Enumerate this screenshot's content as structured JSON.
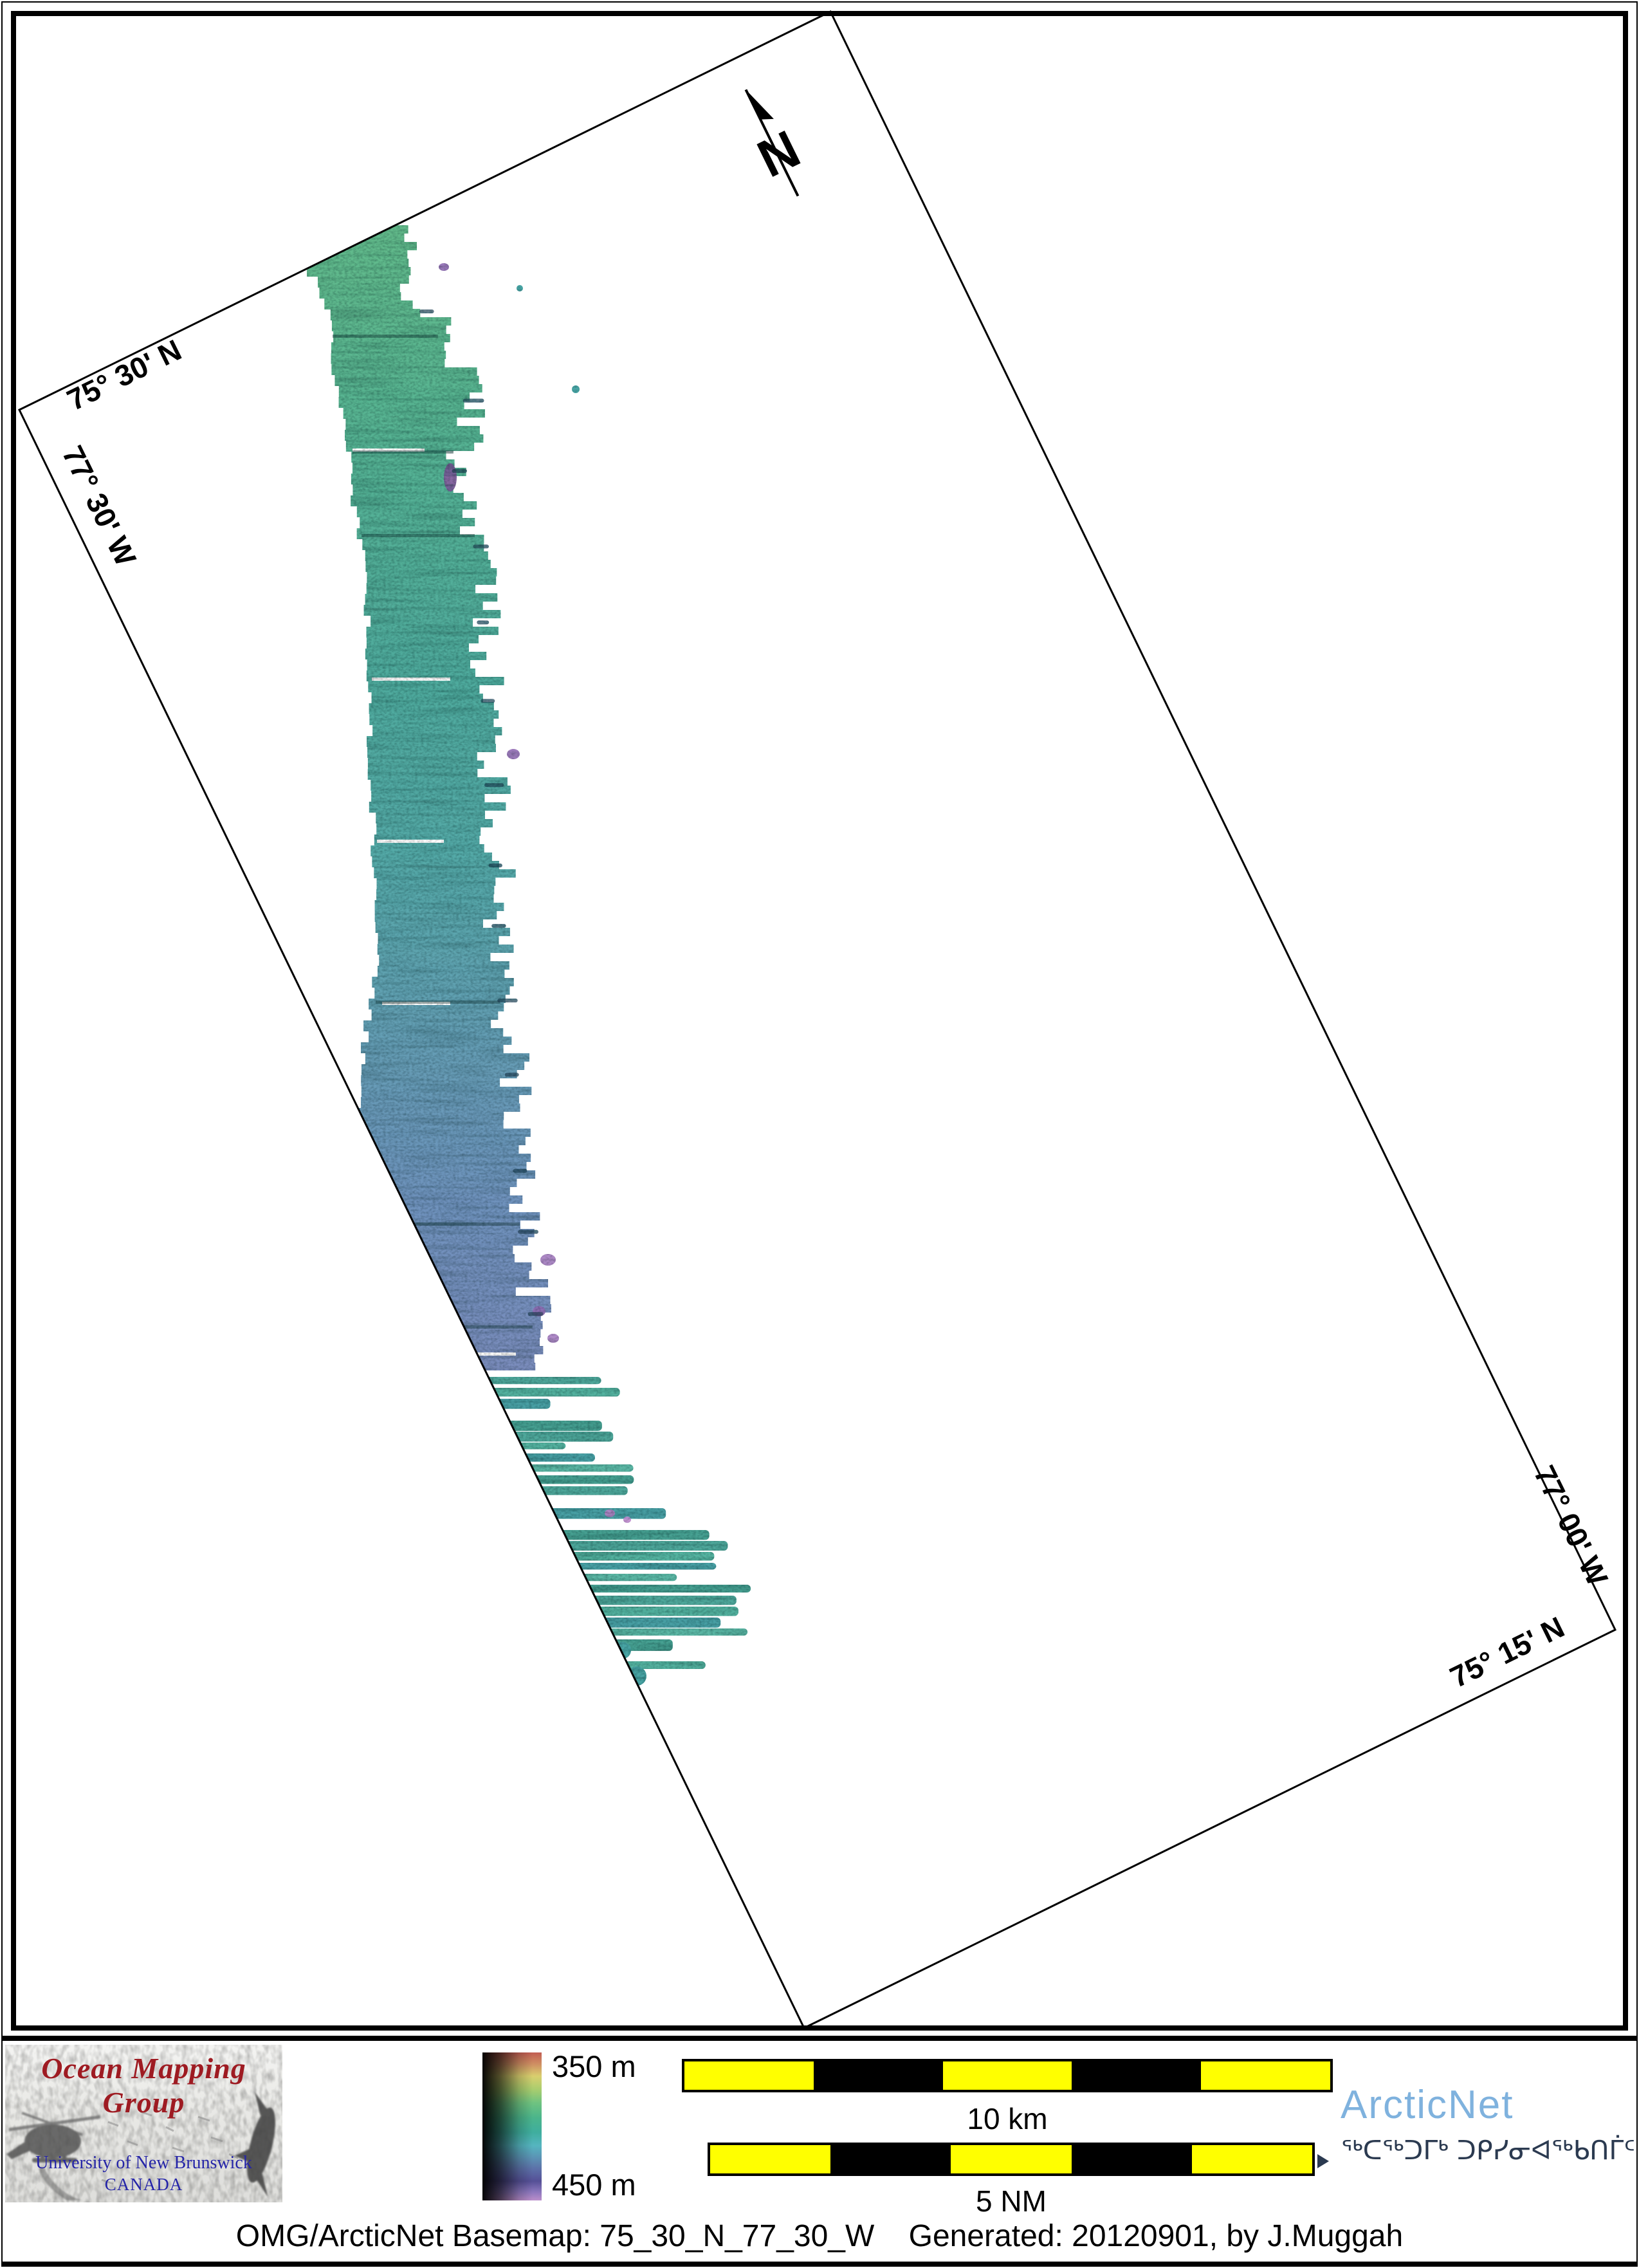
{
  "map": {
    "frame": {
      "rotation_deg": -26.15,
      "corner_labels": {
        "top": "75° 30' N",
        "left": "77° 30' W",
        "right": "77° 00' W",
        "bottom": "75° 15' N"
      }
    },
    "north_label": "N",
    "swath_gradient": [
      {
        "pos": 0.0,
        "color": "#63bb8b"
      },
      {
        "pos": 0.2,
        "color": "#56b394"
      },
      {
        "pos": 0.4,
        "color": "#50ab9e"
      },
      {
        "pos": 0.55,
        "color": "#55aaa8"
      },
      {
        "pos": 0.7,
        "color": "#649fb4"
      },
      {
        "pos": 0.85,
        "color": "#6f93bd"
      },
      {
        "pos": 1.0,
        "color": "#7b8dbd"
      }
    ],
    "streak_colors": [
      "#4fa89b",
      "#55b3a0",
      "#49a0a5",
      "#5bb7a5",
      "#47a092"
    ],
    "accent_colors": [
      "#9d76c0",
      "#a87fc4",
      "#8f6cb4",
      "#b583c8",
      "#c18bd0",
      "#7a5898"
    ]
  },
  "legend": {
    "omg": {
      "title": "Ocean Mapping Group",
      "title_color": "#9e1b22",
      "subtitle1": "University of New Brunswick",
      "subtitle2": "CANADA",
      "subtitle_color": "#2424a8"
    },
    "colorbar": {
      "top_label": "350 m",
      "bottom_label": "450 m",
      "stops": [
        {
          "pos": 0,
          "color": "#c25d52"
        },
        {
          "pos": 8,
          "color": "#cf9063"
        },
        {
          "pos": 16,
          "color": "#d9cf6e"
        },
        {
          "pos": 25,
          "color": "#a9cd6e"
        },
        {
          "pos": 34,
          "color": "#6fc380"
        },
        {
          "pos": 44,
          "color": "#4bb58b"
        },
        {
          "pos": 54,
          "color": "#3fae9e"
        },
        {
          "pos": 63,
          "color": "#55b5c0"
        },
        {
          "pos": 71,
          "color": "#5b93b5"
        },
        {
          "pos": 79,
          "color": "#5c6fa8"
        },
        {
          "pos": 87,
          "color": "#555097"
        },
        {
          "pos": 94,
          "color": "#8a76bc"
        },
        {
          "pos": 100,
          "color": "#bb8ecb"
        }
      ]
    },
    "scalebars": [
      {
        "label": "10 km",
        "segments": [
          "#ffff00",
          "#000000",
          "#ffff00",
          "#000000",
          "#ffff00"
        ]
      },
      {
        "label": "5 NM",
        "segments": [
          "#ffff00",
          "#000000",
          "#ffff00",
          "#000000",
          "#ffff00"
        ]
      }
    ],
    "arcticnet": {
      "wordmark": "ArcticNet",
      "wordmark_color": "#7fb2de",
      "inuktitut": "ᖅᑕᖅᑐᒥᒃ ᑐᑭᓯᓂᐊᖅᑲᑎᒦᑦ",
      "inuktitut_color": "#2b3a50"
    }
  },
  "caption": "OMG/ArcticNet Basemap: 75_30_N_77_30_W    Generated: 20120901, by J.Muggah"
}
